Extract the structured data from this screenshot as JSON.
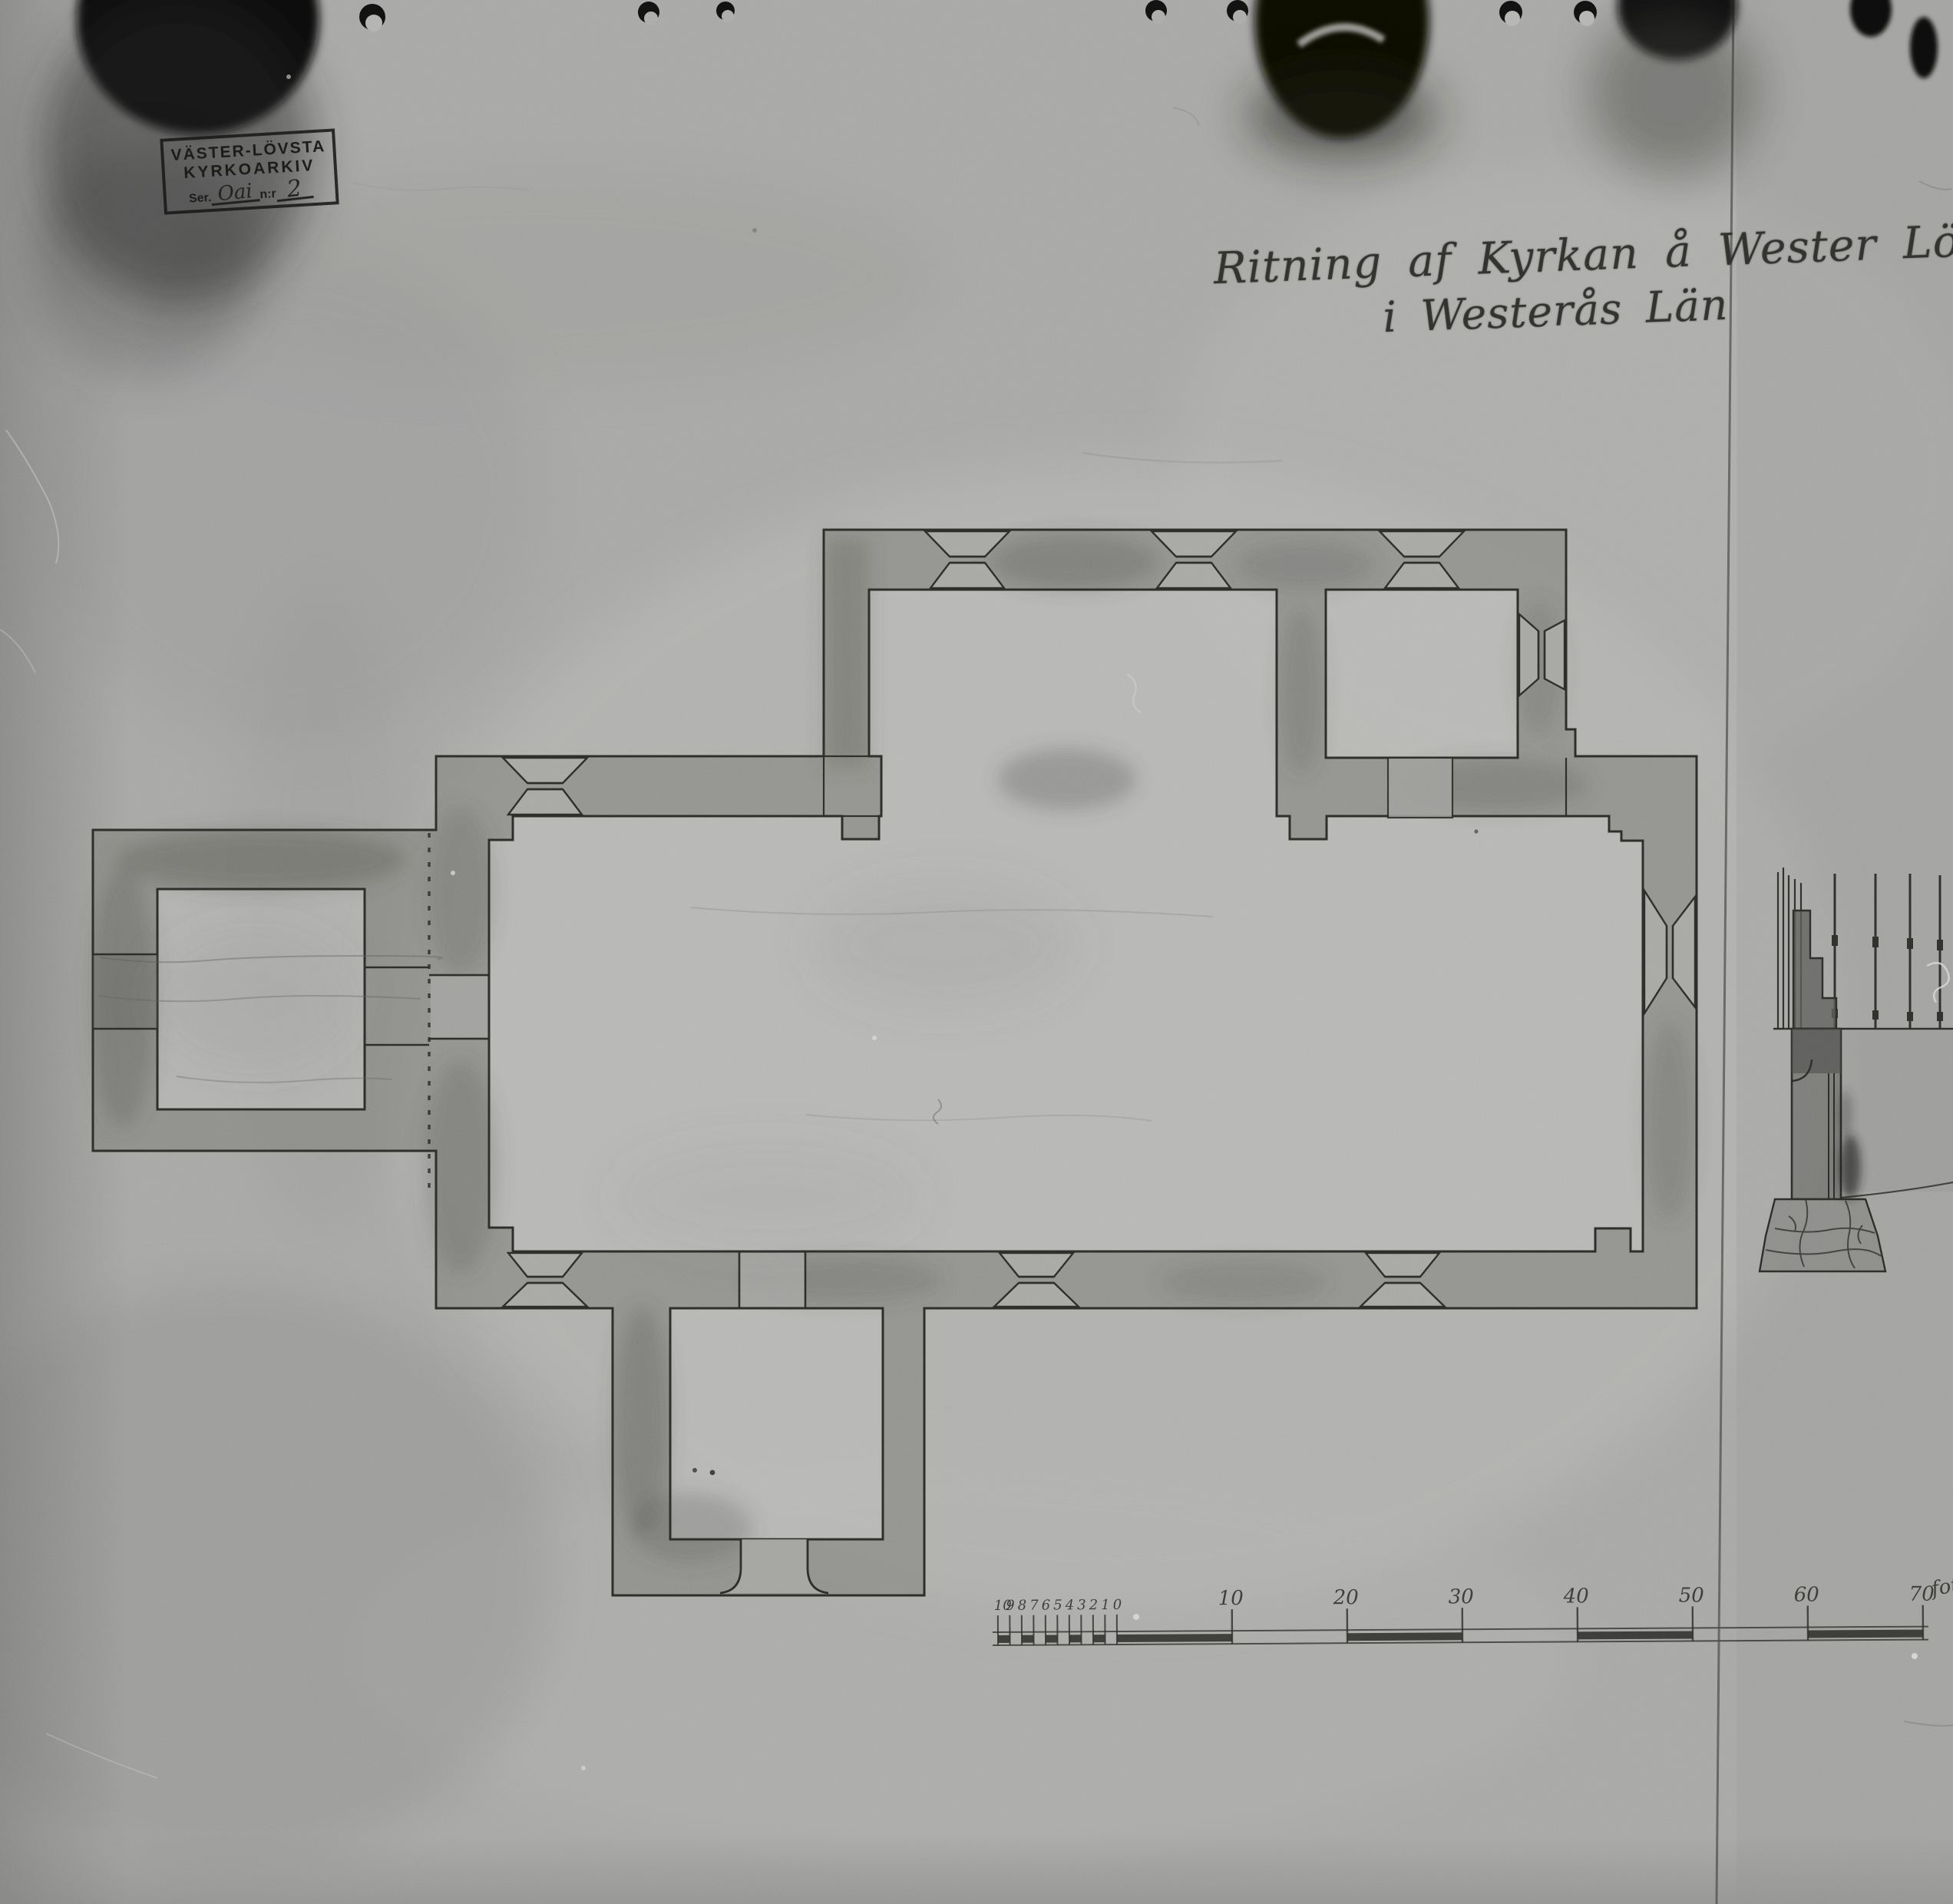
{
  "archive_stamp": {
    "line1": "VÄSTER-LÖVSTA",
    "line2": "KYRKOARKIV",
    "series_label": "Ser.",
    "series_value": "Oai",
    "number_label": "n:r",
    "number_value": "2"
  },
  "title": {
    "line1": "Ritning af Kyrkan å Wester Löfsta",
    "line2": "i Westerås Län"
  },
  "scale_bar": {
    "minor_labels": [
      "10",
      "9",
      "8",
      "7",
      "6",
      "5",
      "4",
      "3",
      "2",
      "1",
      "0"
    ],
    "major_labels": [
      "10",
      "20",
      "30",
      "40",
      "50",
      "60",
      "70"
    ],
    "unit_label": "fot."
  },
  "figures": {
    "floor_plan": "church-floor-plan",
    "section_detail": "wall-section-with-pier-and-foundation",
    "scale": "graphic-scale-in-feet"
  },
  "colors": {
    "paper": "#a7a7a5",
    "paper_light": "#b6b6b4",
    "wall_wash": "#7c7c78",
    "outline_ink": "#2b2b28",
    "handwriting_ink": "#33332f",
    "stamp_ink": "#1b1b19",
    "artifact_black": "#0a0a0a"
  }
}
